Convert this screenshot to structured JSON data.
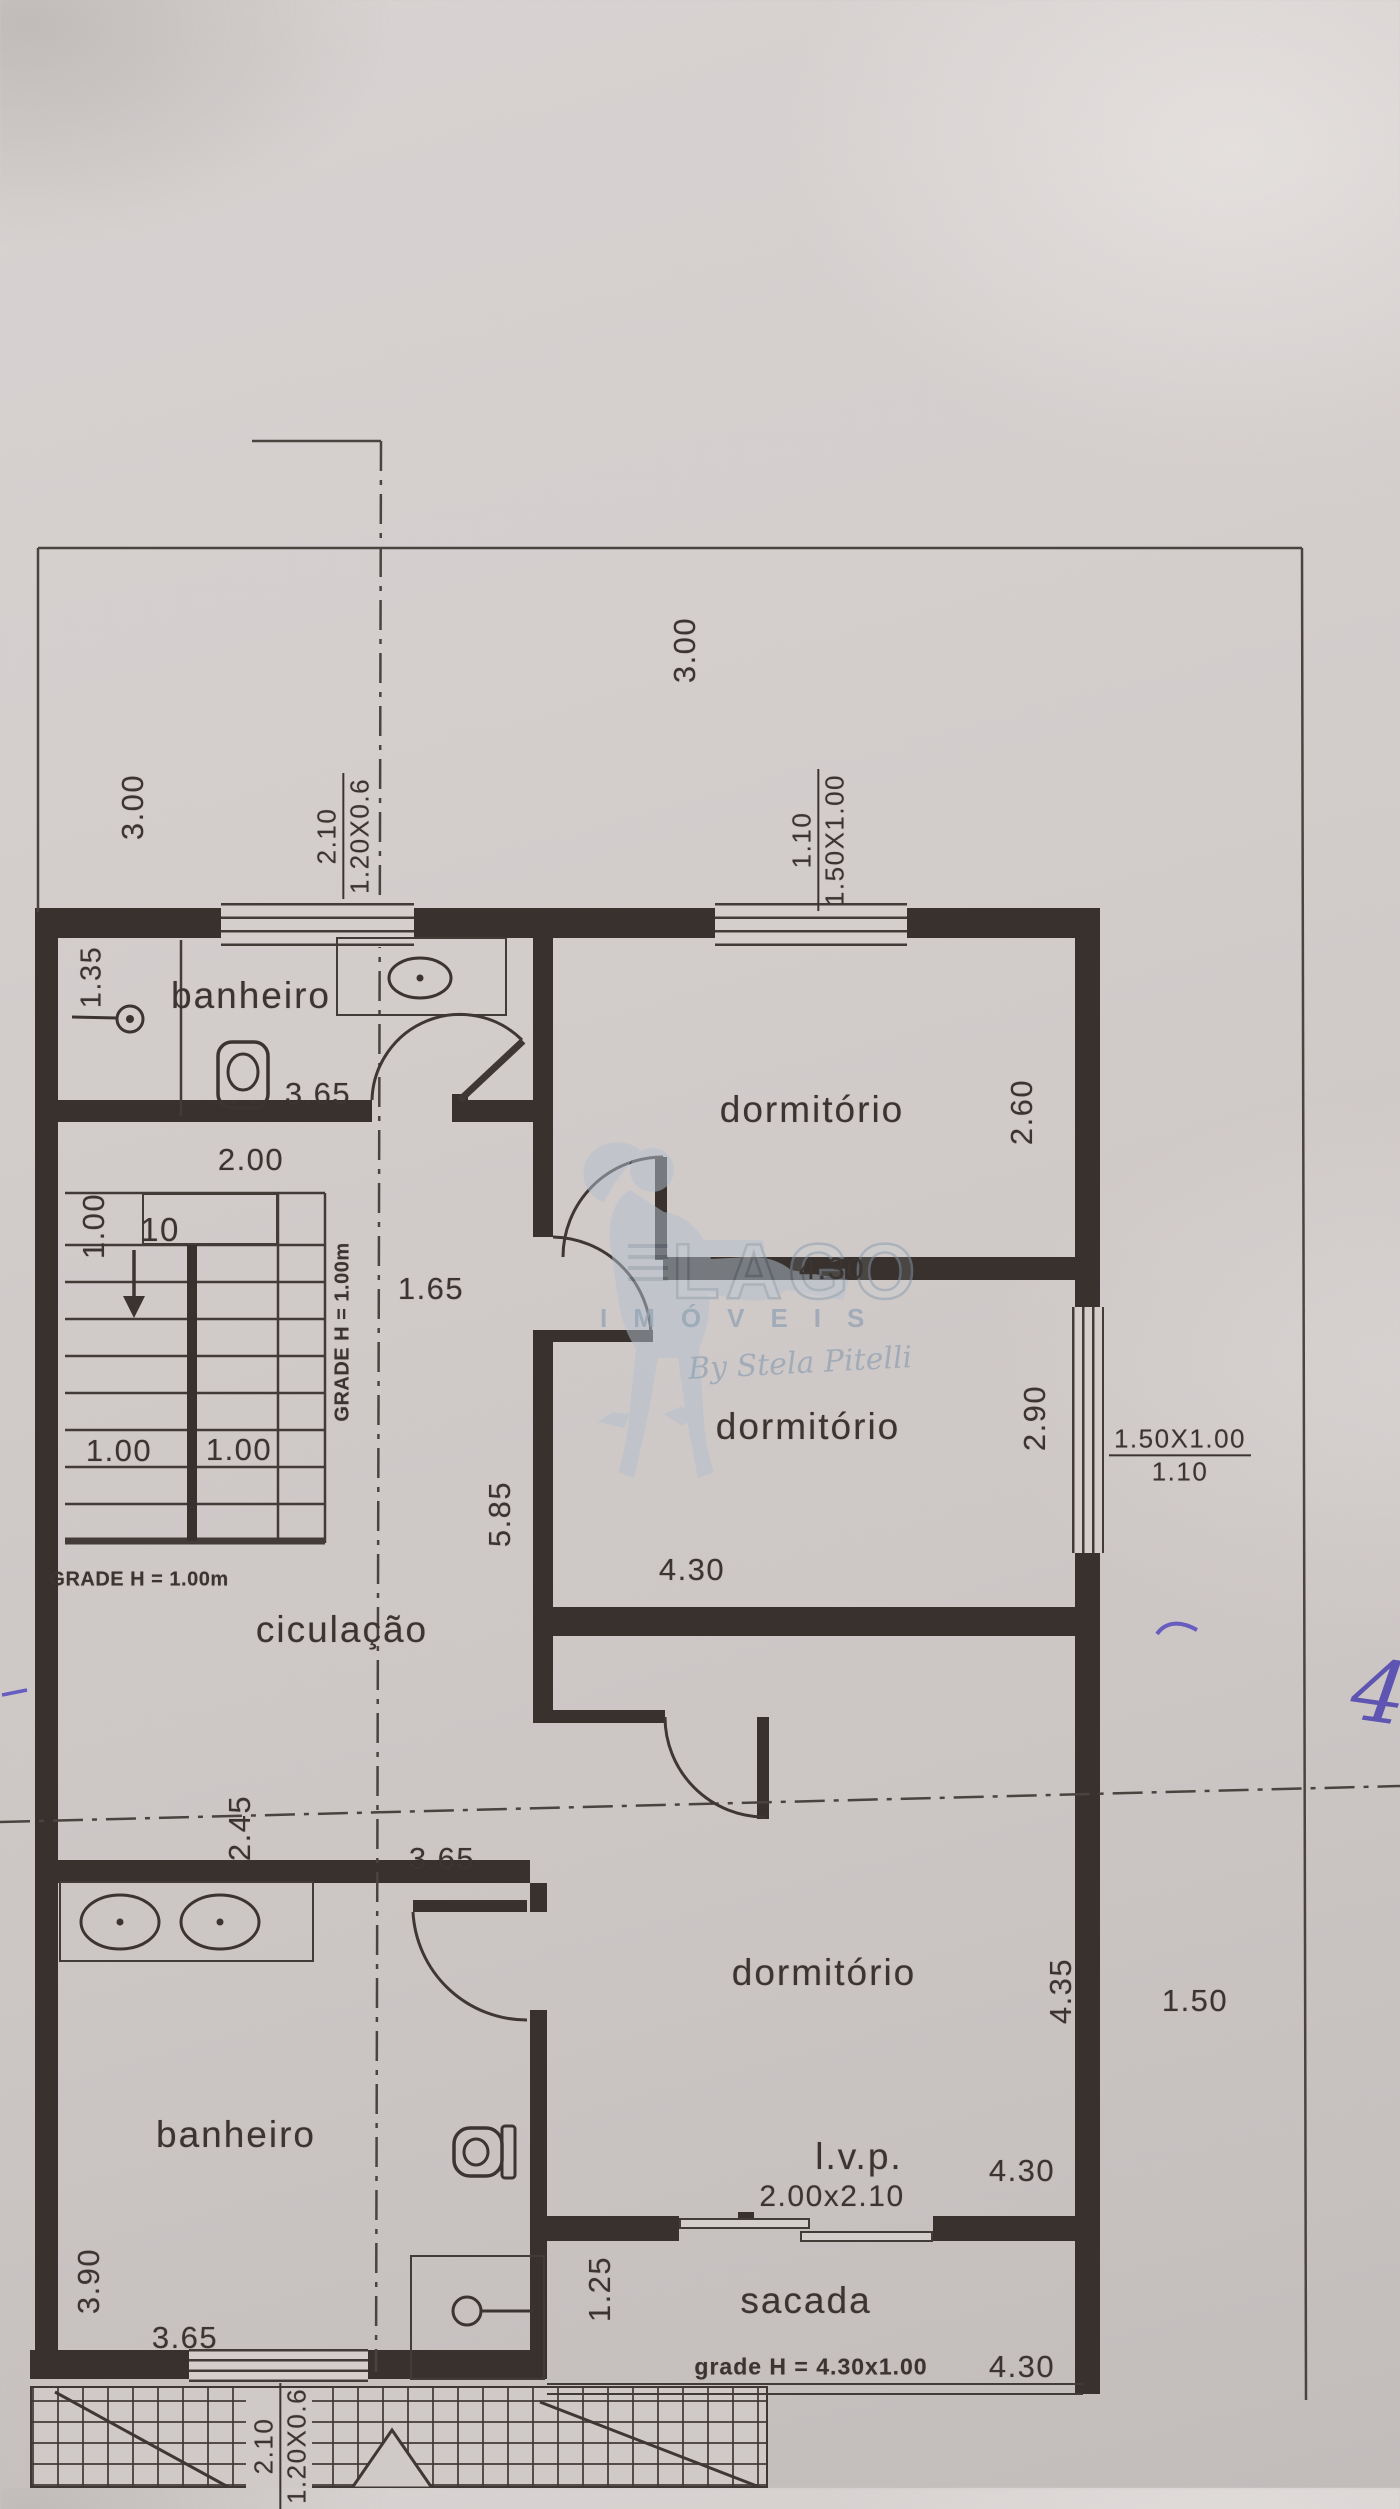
{
  "watermark": {
    "brand": "LAGO",
    "subtitle": "IMÓVEIS",
    "script": "By Stela Pitelli"
  },
  "rooms": {
    "bathroom_top": "banheiro",
    "bedroom_top": "dormitório",
    "bedroom_middle": "dormitório",
    "bedroom_bottom": "dormitório",
    "circulation": "ciculação",
    "bathroom_bottom": "banheiro",
    "lvp": "l.v.p.",
    "balcony": "sacada"
  },
  "dimensions": {
    "lot_top": "3.00",
    "lot_left": "3.00",
    "shower_width": "1.35",
    "bathroom_top_width": "3.65",
    "bedroom_top_height": "2.60",
    "bedroom_top_width": "4.30",
    "stair_landing": "2.00",
    "stair_width": "1.00",
    "stair_flight_left": "1.00",
    "stair_flight_right": "1.00",
    "hall_door": "1.65",
    "hall_length": "5.85",
    "bedroom_middle_height": "2.90",
    "bedroom_middle_width": "4.30",
    "circulation_depth": "2.45",
    "circulation_width": "3.65",
    "bedroom_bottom_height": "4.35",
    "side_setback": "1.50",
    "bathroom_bottom_height": "3.90",
    "bathroom_bottom_width": "3.65",
    "lvp_width": "4.30",
    "balcony_depth": "1.25",
    "balcony_width": "4.30"
  },
  "windows": {
    "bathroom_top": {
      "size": "1.20X0.6",
      "sill": "2.10"
    },
    "bedroom_top": {
      "size": "1.50X1.00",
      "sill": "1.10"
    },
    "bedroom_middle": {
      "size": "1.50X1.00",
      "sill": "1.10"
    },
    "bathroom_bottom": {
      "size": "1.20X0.6",
      "sill": "2.10"
    }
  },
  "notes": {
    "stair_count": "10",
    "stair_grade_vertical": "GRADE H = 1.00m",
    "stair_grade_horizontal": "GRADE H = 1.00m",
    "lvp_opening": "2.00x2.10",
    "balcony_grade": "grade H = 4.30x1.00",
    "handwritten_mark": "4"
  }
}
